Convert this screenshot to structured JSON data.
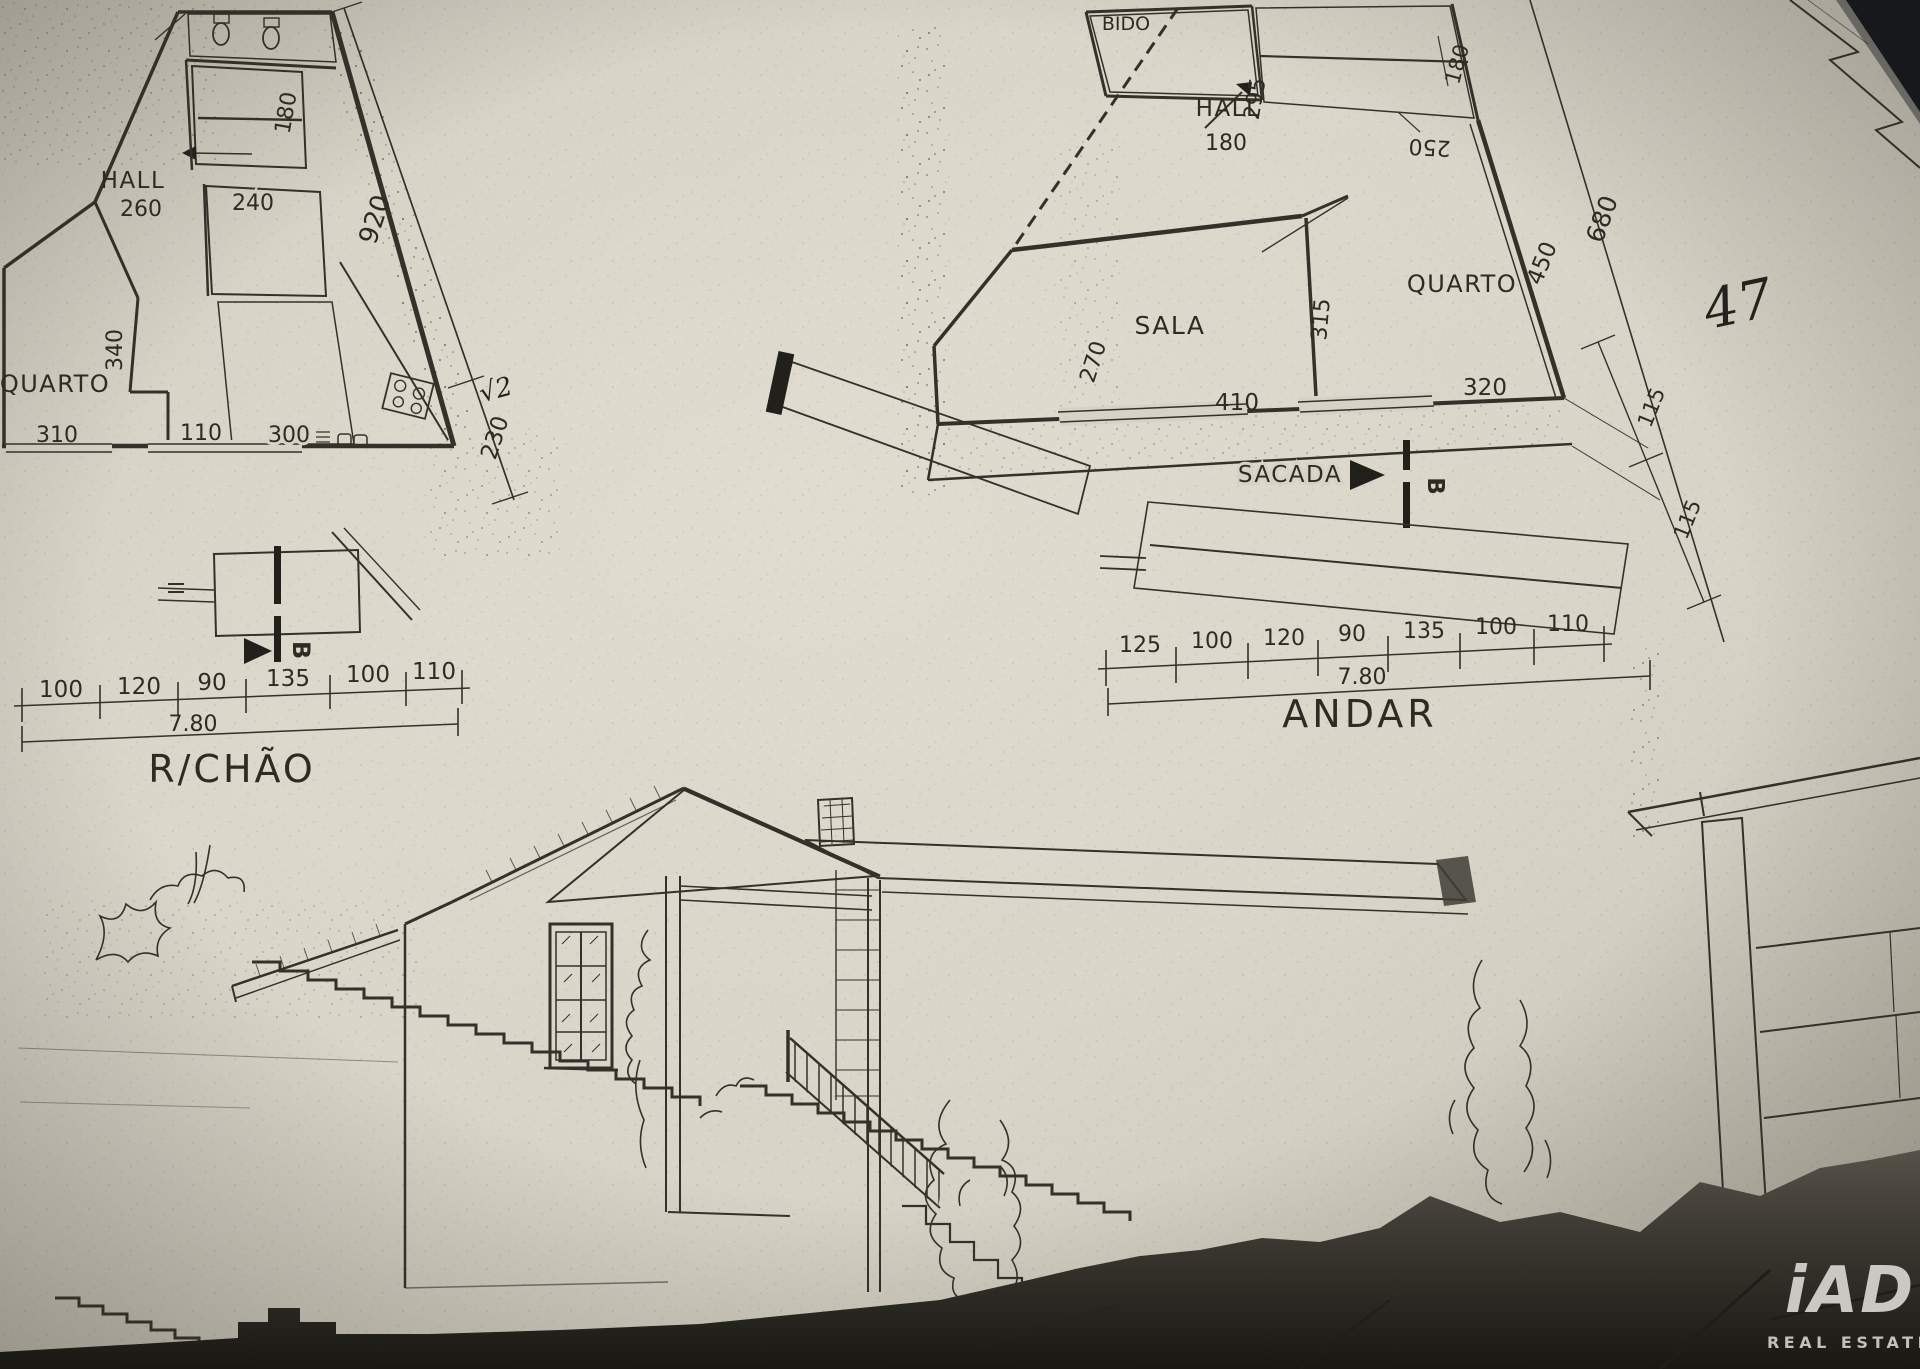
{
  "document": {
    "kind": "Scanned hand-drawn architectural floor plan photo"
  },
  "colors": {
    "paper": "#d6d2c6",
    "ink": "#33312a",
    "background_dark": "#2a2620"
  },
  "rchao": {
    "title": "R/CHÃO",
    "total": "7.80",
    "chain": [
      "100",
      "120",
      "90",
      "135",
      "100",
      "110"
    ],
    "hall": "HALL",
    "hall_dim": "260",
    "quarto": "QUARTO",
    "d340": "340",
    "d310": "310",
    "d110": "110",
    "d300": "300",
    "d240": "240",
    "d180": "180",
    "d920": "920",
    "d230": "230",
    "note": "√2",
    "section": "B"
  },
  "andar": {
    "title": "ANDAR",
    "total": "7.80",
    "chain": [
      "125",
      "100",
      "120",
      "90",
      "135",
      "100",
      "110"
    ],
    "wc": "BIDO",
    "hall": "HALL",
    "hall_dim": "180",
    "d295": "295",
    "d250": "250",
    "sala": "SALA",
    "d270": "270",
    "d410": "410",
    "d315": "315",
    "quarto": "QUARTO",
    "d320": "320",
    "d450": "450",
    "d680": "680",
    "d180": "180",
    "d115a": "115",
    "d115b": "115",
    "sacada": "SACADA",
    "section": "B"
  },
  "annotations": {
    "handwritten": "47"
  },
  "watermark": {
    "logo": "iAD",
    "tagline": "REAL ESTATE"
  }
}
